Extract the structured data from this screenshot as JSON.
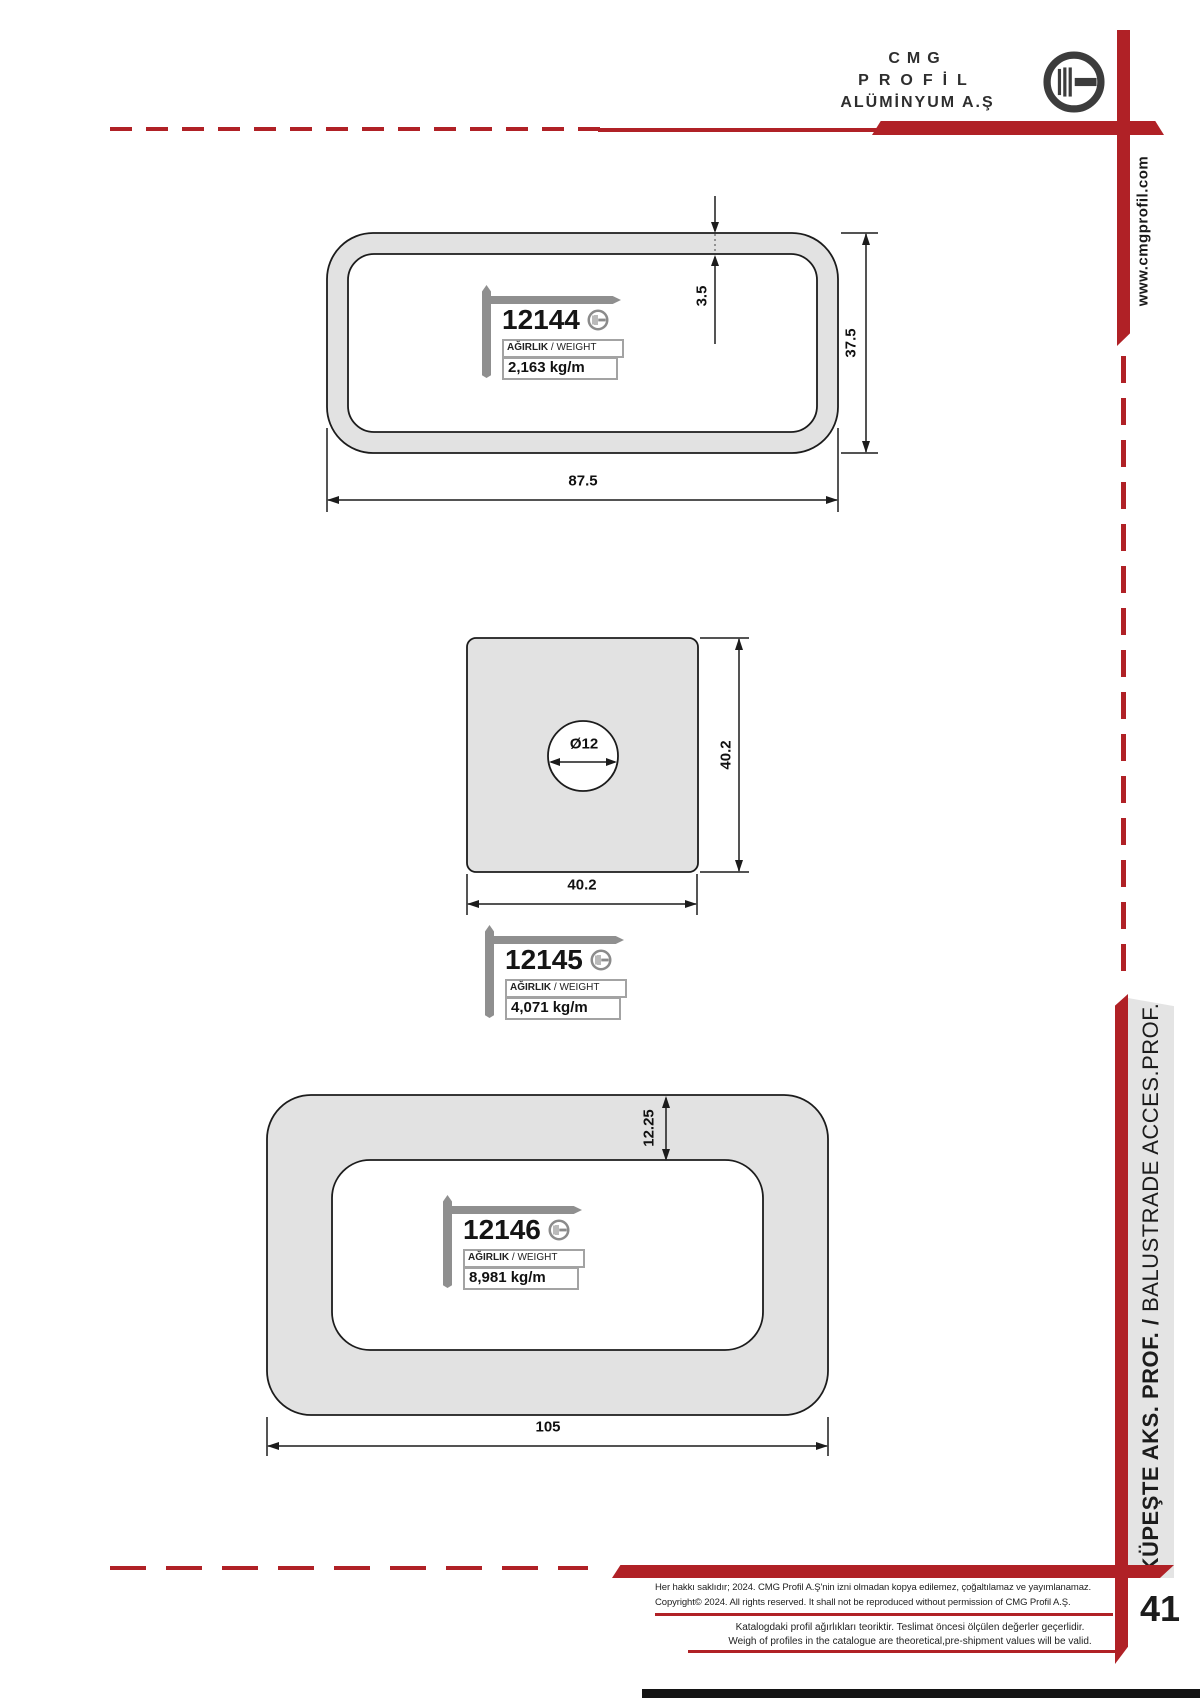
{
  "header": {
    "company_line1": "CMG",
    "company_line2": "PROFİL",
    "company_line3": "ALÜMİNYUM A.Ş",
    "website": "www.cmgprofil.com"
  },
  "sidebar": {
    "category_tr": "KÜPEŞTE AKS. PROF. / ",
    "category_en": "BALUSTRADE ACCES.PROF."
  },
  "page_number": "41",
  "weight_label": {
    "tr": "AĞIRLIK",
    "en": " / WEIGHT"
  },
  "profiles": [
    {
      "code": "12144",
      "weight": "2,163 kg/m",
      "dim_wall": "3.5",
      "dim_height": "37.5",
      "dim_width": "87.5"
    },
    {
      "code": "12145",
      "weight": "4,071 kg/m",
      "dim_hole": "Ø12",
      "dim_height": "40.2",
      "dim_width": "40.2"
    },
    {
      "code": "12146",
      "weight": "8,981 kg/m",
      "dim_wall": "12.25",
      "dim_width": "105"
    }
  ],
  "footer": {
    "line1_tr": "Her hakkı saklıdır; 2024. CMG Profil A.Ş'nin izni olmadan kopya edilemez, çoğaltılamaz ve yayımlanamaz.",
    "line1_en": "Copyright© 2024. All rights reserved. It shall not be reproduced without permission of CMG Profil A.Ş.",
    "line2_tr": "Katalogdaki profil ağırlıkları teoriktir. Teslimat öncesi ölçülen değerler geçerlidir.",
    "line2_en": "Weigh of profiles in the catalogue are theoretical,pre-shipment values will be valid."
  },
  "colors": {
    "accent_red": "#b02126",
    "profile_fill": "#e2e2e2",
    "bracket_gray": "#8f8f8f"
  }
}
